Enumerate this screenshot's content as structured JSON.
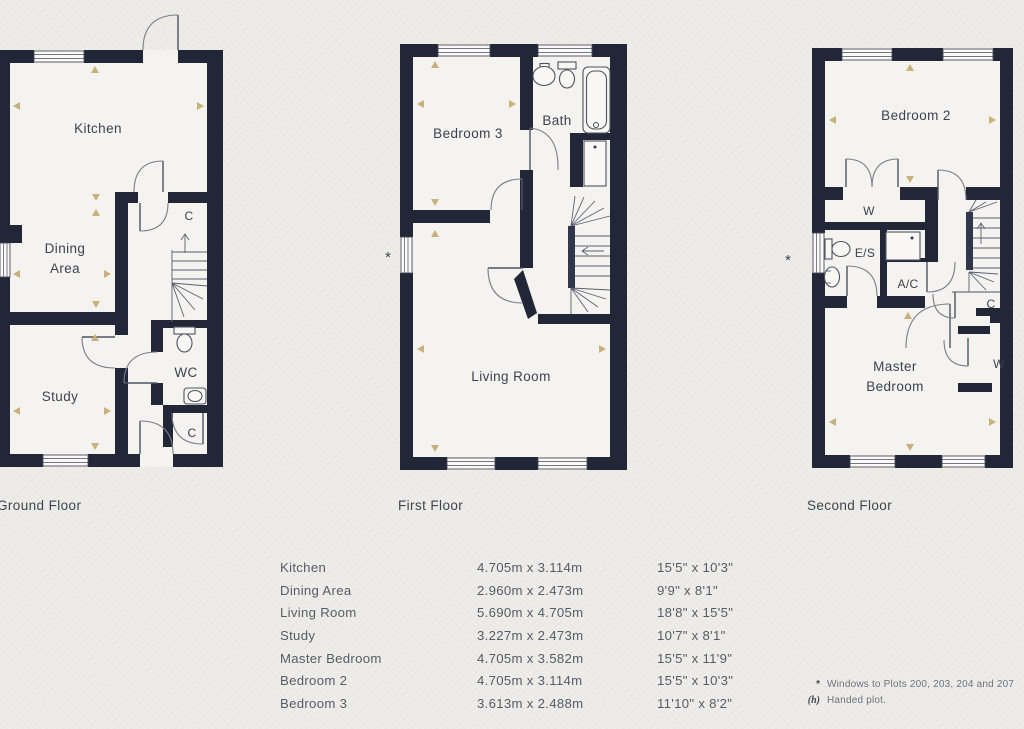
{
  "colors": {
    "wall": "#212737",
    "paper": "#efeeea",
    "marker": "#c8b17b",
    "label_text": "#3b4252"
  },
  "floors": {
    "ground": {
      "caption": "Ground Floor",
      "labels": {
        "kitchen": "Kitchen",
        "dining_line1": "Dining",
        "dining_line2": "Area",
        "study": "Study",
        "wc": "WC",
        "cupboard_top": "C",
        "cupboard_bottom": "C"
      }
    },
    "first": {
      "caption": "First Floor",
      "labels": {
        "bedroom3": "Bedroom 3",
        "bath": "Bath",
        "living_room": "Living Room"
      },
      "window_note_marker": "*"
    },
    "second": {
      "caption": "Second Floor",
      "labels": {
        "bedroom2": "Bedroom 2",
        "wardrobe_top": "W",
        "ensuite": "E/S",
        "airing_cupboard": "A/C",
        "cupboard": "C",
        "wardrobe_bottom": "W",
        "master_line1": "Master",
        "master_line2": "Bedroom"
      },
      "window_note_marker": "*"
    }
  },
  "dimensions_table": {
    "rows": [
      {
        "room": "Kitchen",
        "metric": "4.705m x 3.114m",
        "imperial": "15'5\" x 10'3\""
      },
      {
        "room": "Dining Area",
        "metric": "2.960m x 2.473m",
        "imperial": "9'9\" x 8'1\""
      },
      {
        "room": "Living Room",
        "metric": "5.690m x 4.705m",
        "imperial": "18'8\" x 15'5\""
      },
      {
        "room": "Study",
        "metric": "3.227m x 2.473m",
        "imperial": "10'7\" x 8'1\""
      },
      {
        "room": "Master Bedroom",
        "metric": "4.705m x 3.582m",
        "imperial": "15'5\" x 11'9\""
      },
      {
        "room": "Bedroom 2",
        "metric": "4.705m x 3.114m",
        "imperial": "15'5\" x 10'3\""
      },
      {
        "room": "Bedroom 3",
        "metric": "3.613m x 2.488m",
        "imperial": "11'10\" x 8'2\""
      }
    ]
  },
  "footnotes": [
    {
      "marker": "*",
      "text": "Windows to Plots 200, 203, 204 and 207"
    },
    {
      "marker": "(h)",
      "text": "Handed plot."
    }
  ]
}
